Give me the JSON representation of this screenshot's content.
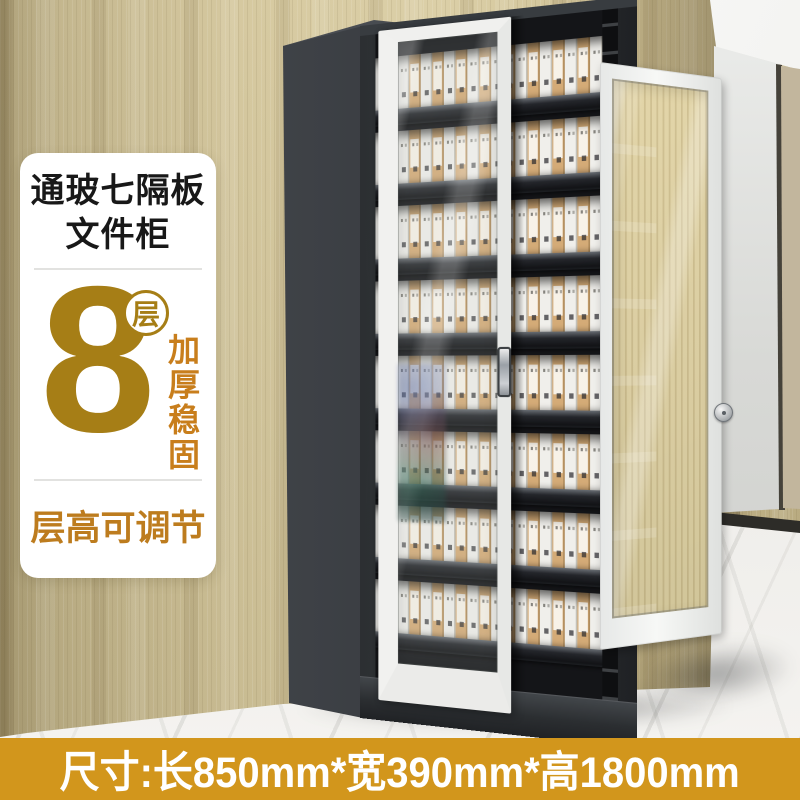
{
  "card": {
    "title_line1": "通玻七隔板",
    "title_line2": "文件柜",
    "tier_number": "8",
    "tier_unit": "层",
    "feature_vertical": "加厚稳固",
    "feature_adjustable": "层高可调节"
  },
  "banner": {
    "size_text": "尺寸:长850mm*宽390mm*高1800mm"
  },
  "cabinet": {
    "shelf_rows": 8
  },
  "icons": {
    "door_handle": "vertical-bar-handle",
    "lock_knob": "round-lock-knob"
  },
  "colors": {
    "accent_gold": "#a67e16",
    "accent_orange": "#c87e1c",
    "accent_orange_dark": "#bd7c1e",
    "banner_bg": "#d2961c",
    "banner_text": "#ffffff",
    "cabinet_body": "#34373b",
    "door_frame": "#f1f1ef",
    "binder_kraft": "#d4ab77",
    "binder_white": "#f0efeb",
    "wall_wood": "#cfc096",
    "floor_marble": "#efedea"
  }
}
